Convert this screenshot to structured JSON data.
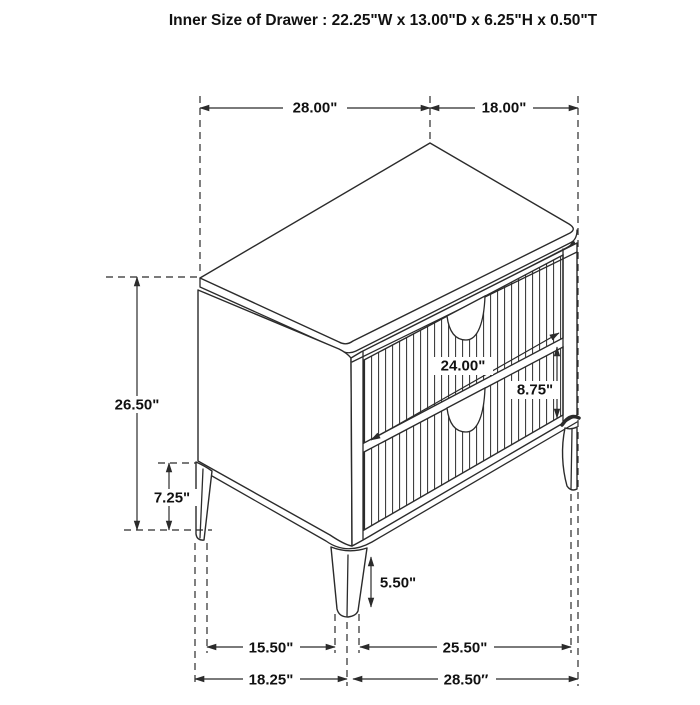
{
  "title": "Inner Size of Drawer : 22.25\"W x 13.00\"D x 6.25\"H x 0.50\"T",
  "figure_description": "Isometric line drawing of a two-drawer nightstand with fluted drawer fronts, notch handles and tapered legs",
  "colors": {
    "line": "#2b2b2b",
    "text": "#111111",
    "background": "#ffffff"
  },
  "dims": {
    "top_width": "28.00\"",
    "top_depth": "18.00\"",
    "overall_height": "26.50\"",
    "back_leg_height": "7.25\"",
    "drawer_front_width": "24.00\"",
    "drawer_front_height": "8.75\"",
    "front_leg_height": "5.50\"",
    "leg_span_side": "15.50\"",
    "leg_span_front": "25.50\"",
    "base_depth": "18.25\"",
    "base_width": "28.50″"
  }
}
